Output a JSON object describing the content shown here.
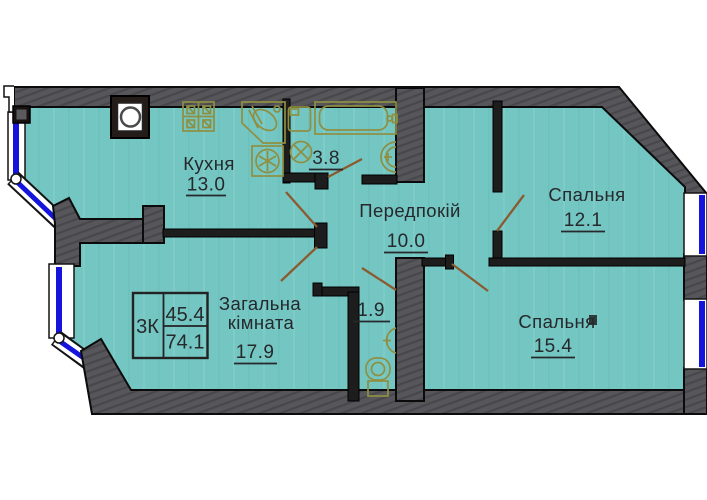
{
  "plan_type": "apartment-floor-plan",
  "rooms": {
    "kitchen": {
      "name": "Кухня",
      "area": "13.0"
    },
    "hallway": {
      "name": "Передпокій",
      "area": "10.0"
    },
    "bedroom_small": {
      "name": "Спальня",
      "area": "12.1"
    },
    "bedroom_large": {
      "name": "Спальня",
      "area": "15.4"
    },
    "living": {
      "name_line1": "Загальна",
      "name_line2": "кімната",
      "area": "17.9"
    },
    "bathroom": {
      "area": "3.8"
    },
    "wc": {
      "area": "1.9"
    }
  },
  "info_table": {
    "apartment_type": "3К",
    "living_area": "45.4",
    "total_area": "74.1"
  },
  "fixtures": [
    "stove",
    "kitchen-corner-sink",
    "washing-machine",
    "vent-shaft",
    "bathtub",
    "washbasin",
    "toilet"
  ],
  "colors": {
    "floor": "#74c6c3",
    "wall": "#57565b",
    "wall_outline": "#0b0b0b",
    "window_glazing": "#1414dc",
    "door_swing": "#8a5a30",
    "fixture_outline": "#8f8f42",
    "text": "#26282b"
  }
}
